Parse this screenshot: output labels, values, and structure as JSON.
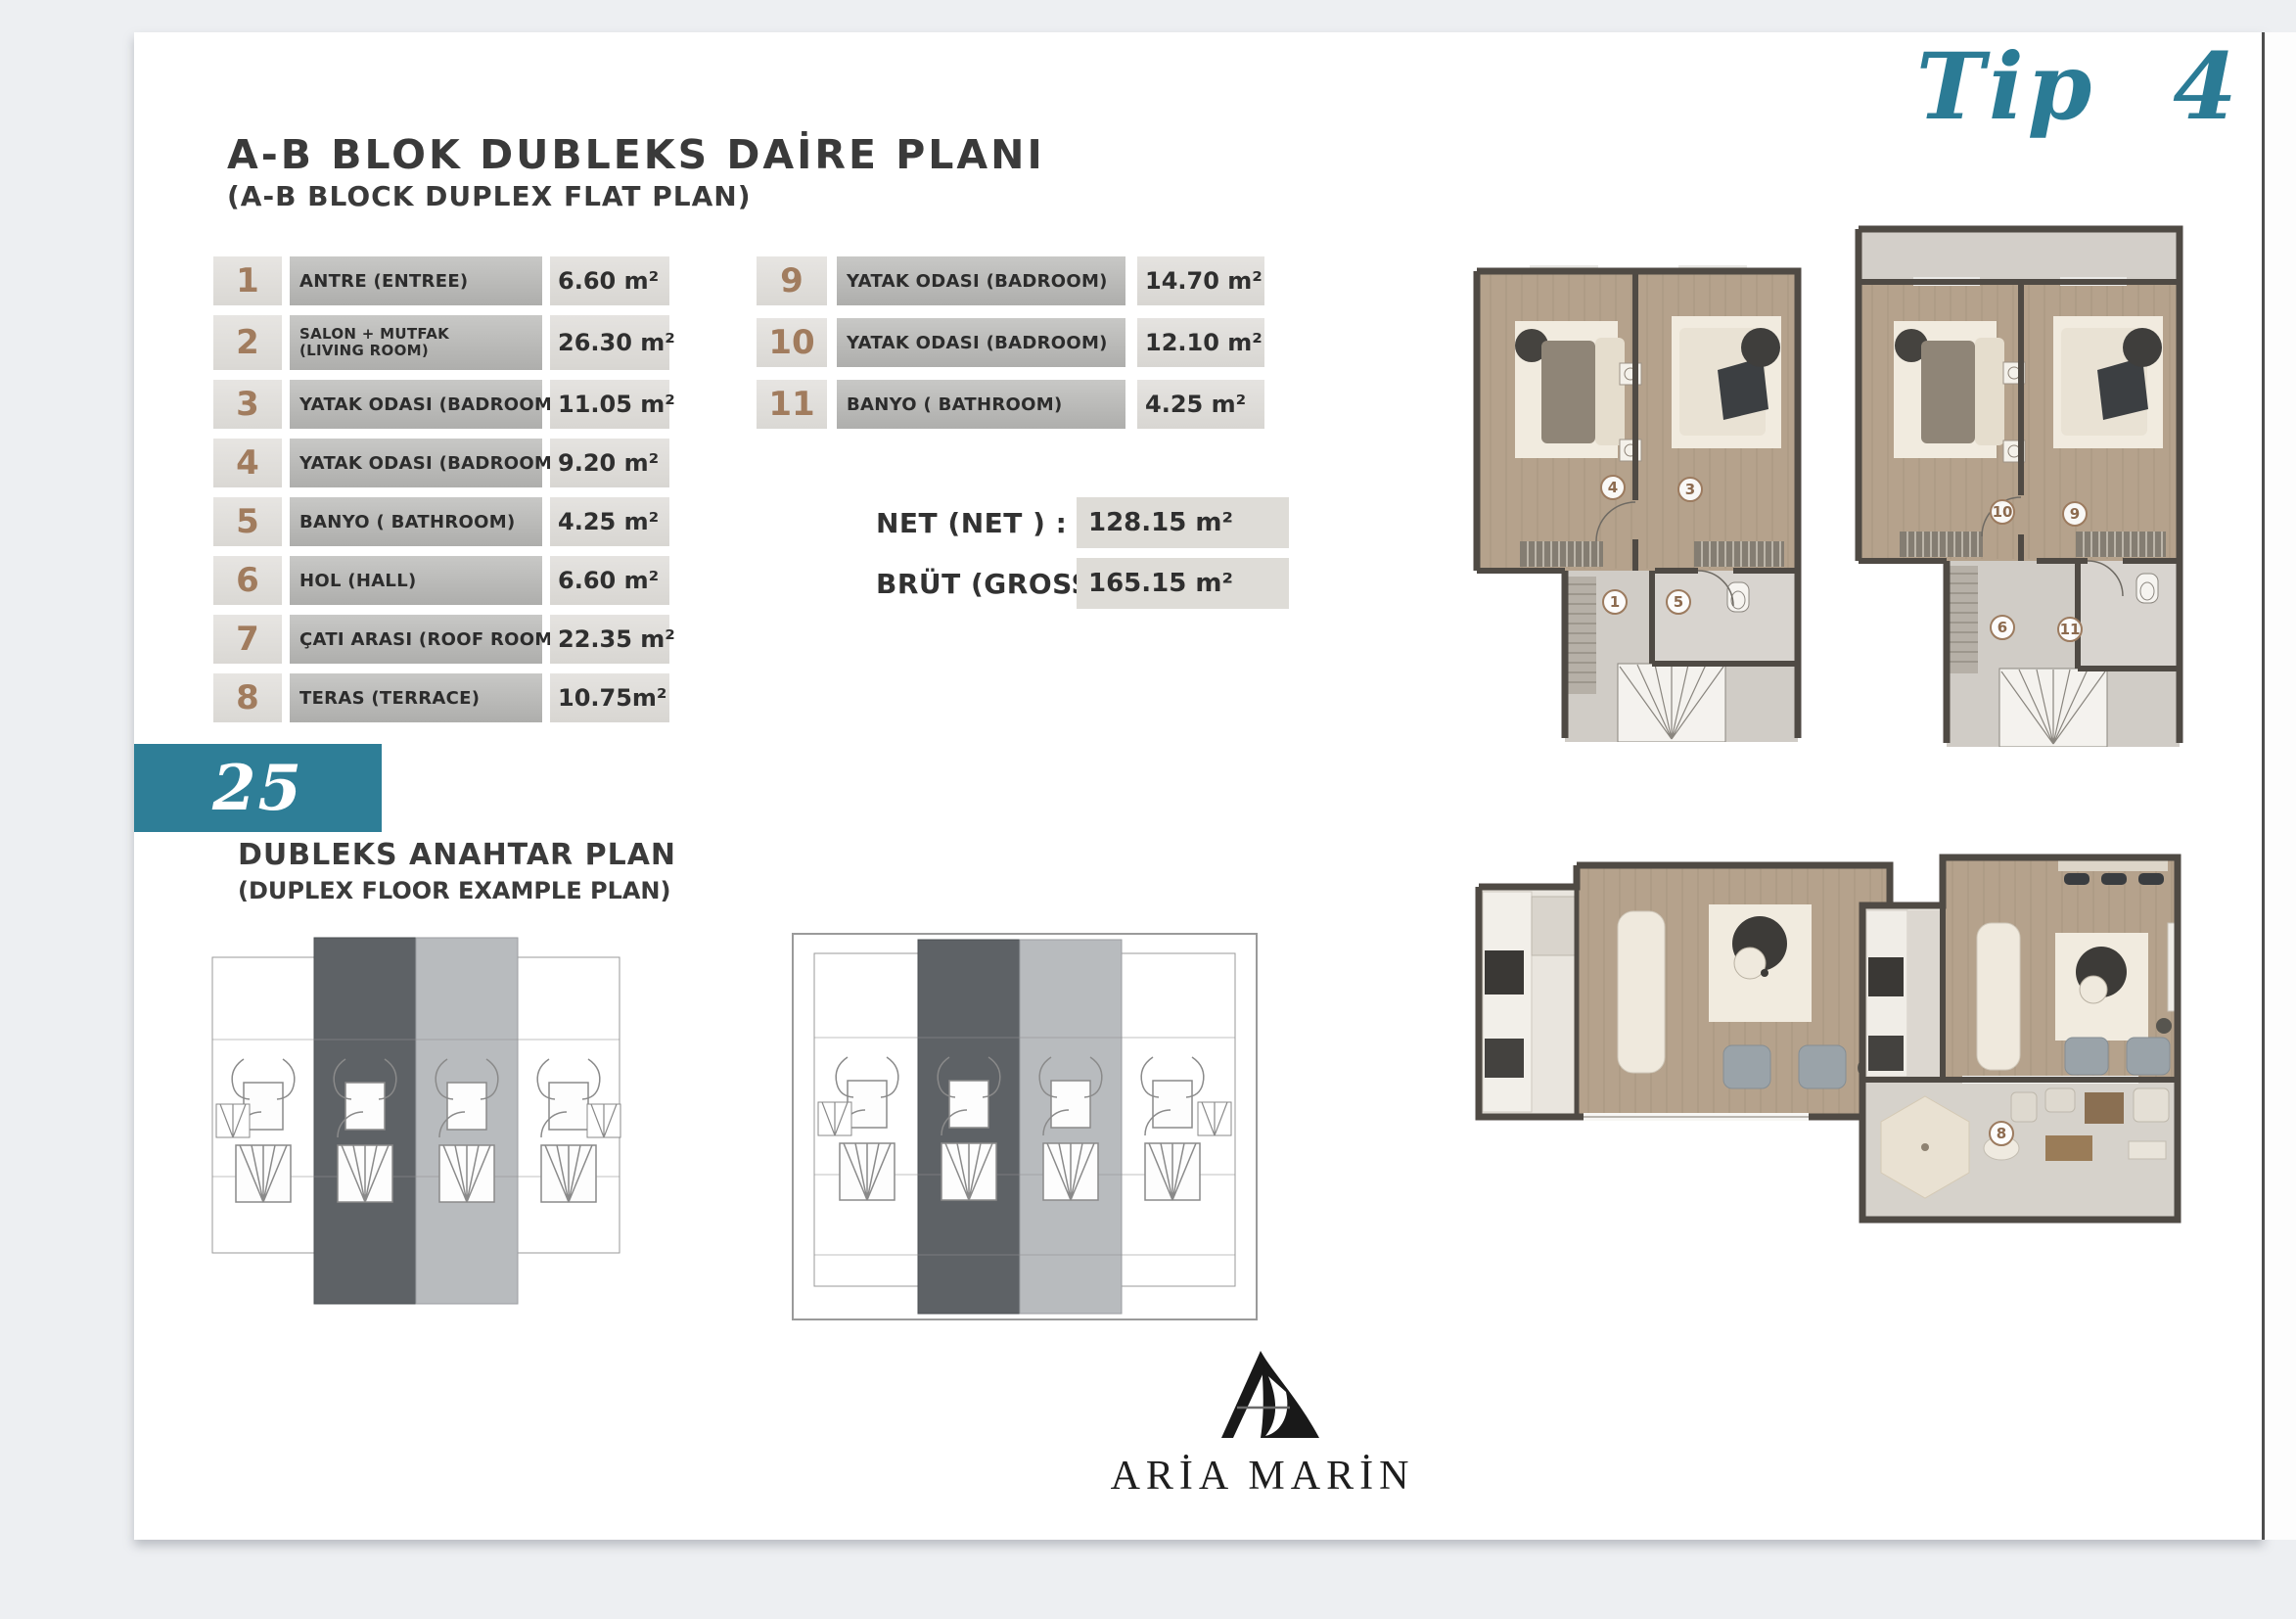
{
  "header": {
    "title": "A-B BLOK DUBLEKS DAİRE PLANI",
    "subtitle": "(A-B BLOCK DUPLEX  FLAT PLAN)",
    "type_label": "Tip 4",
    "page_number": "25"
  },
  "room_table": {
    "left": [
      {
        "no": "1",
        "label": "ANTRE (ENTREE)",
        "area": "6.60 m²"
      },
      {
        "no": "2",
        "label": "SALON + MUTFAK",
        "sublabel": "(LIVING ROOM)",
        "area": "26.30 m²"
      },
      {
        "no": "3",
        "label": "YATAK ODASI (BADROOM)",
        "area": "11.05 m²"
      },
      {
        "no": "4",
        "label": "YATAK ODASI (BADROOM)",
        "area": "9.20 m²"
      },
      {
        "no": "5",
        "label": "BANYO ( BATHROOM)",
        "area": "4.25 m²"
      },
      {
        "no": "6",
        "label": "HOL (HALL)",
        "area": "6.60 m²"
      },
      {
        "no": "7",
        "label": "ÇATI ARASI (ROOF ROOM)",
        "area": "22.35 m²"
      },
      {
        "no": "8",
        "label": "TERAS (TERRACE)",
        "area": "10.75m²"
      }
    ],
    "right": [
      {
        "no": "9",
        "label": "YATAK ODASI (BADROOM)",
        "area": "14.70 m²"
      },
      {
        "no": "10",
        "label": "YATAK ODASI (BADROOM)",
        "area": "12.10 m²"
      },
      {
        "no": "11",
        "label": "BANYO ( BATHROOM)",
        "area": "4.25 m²"
      }
    ]
  },
  "totals": {
    "net_label": "NET (NET ) :",
    "net_value": "128.15 m²",
    "gross_label": "BRÜT (GROSS):",
    "gross_value": "165.15 m²"
  },
  "key_plan": {
    "title": "DUBLEKS ANAHTAR PLAN",
    "subtitle": "(DUPLEX FLOOR EXAMPLE PLAN)"
  },
  "plans": {
    "upper_a": {
      "labels": [
        "4",
        "3",
        "1",
        "5"
      ]
    },
    "upper_b": {
      "labels": [
        "10",
        "9",
        "6",
        "11"
      ]
    },
    "lower_b": {
      "labels": [
        "8"
      ]
    }
  },
  "brand": {
    "name": "ARİA MARİN"
  },
  "colors": {
    "accent_teal": "#2e7e97",
    "number_brown": "#9c7b5f",
    "wall": "#4f4a44",
    "floor_wood": "#b5a28c",
    "keyplan_dark": "#5e6266",
    "keyplan_light": "#b8bbbe"
  }
}
